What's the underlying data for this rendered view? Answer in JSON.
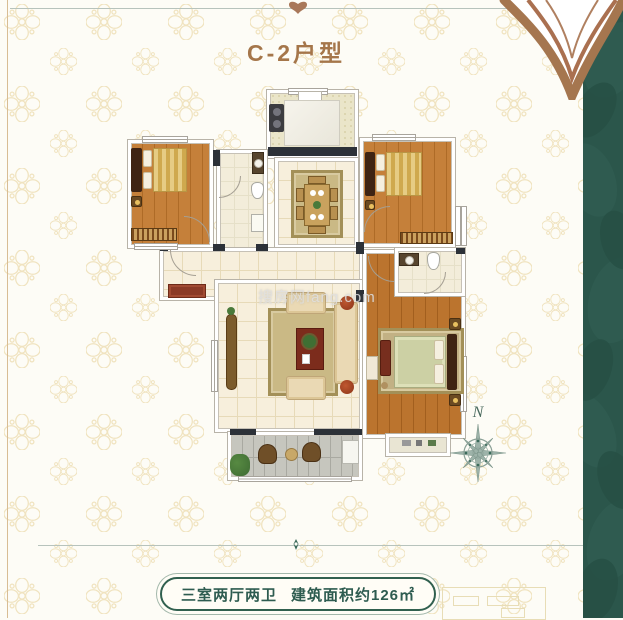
{
  "header": {
    "title": "C-2户型"
  },
  "footer": {
    "spec": "三室两厅两卫",
    "area": "建筑面积约126㎡"
  },
  "floorplan": {
    "watermark": "搜房网fang.com",
    "compass_label": "N"
  },
  "colors": {
    "accent_brown": "#a5764a",
    "band_green": "#2b564b",
    "label_green": "#2e5c50",
    "wall_dark": "#2c3138",
    "wood_floor": "#c5803a",
    "tile_floor": "#f7efdc",
    "bath_floor": "#f3edda",
    "balcony_gray": "#c6c6be"
  }
}
